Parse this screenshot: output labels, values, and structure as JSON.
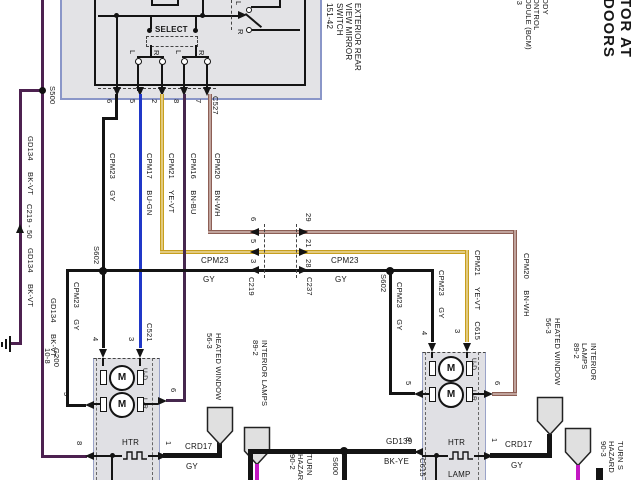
{
  "title": "TOR AT DOORS",
  "bcm": "ODY\nONTROL\nODULE (BCM)\n-3",
  "switch": {
    "name": "EXTERIOR REAR\nVIEW MIRROR\nSWITCH\n151-42",
    "select": "SELECT",
    "selector_l": "L",
    "selector_r": "R",
    "contact1": "L",
    "contact2": "R",
    "contact3": "L",
    "contact4": "R",
    "connector": "C527",
    "pin6": "6",
    "pin5": "5",
    "pin2": "2",
    "pin8": "8",
    "pin7": "7"
  },
  "wires": {
    "cpm23": "CPM23 GY",
    "cpm17": "CPM17 BU-GN",
    "cpm21": "CPM21 YE-VT",
    "cpm16": "CPM16 BN-BU",
    "cpm20": "CPM20 BN-WH",
    "cpm21_c615": "CPM21 YE-VT C615",
    "cpm23_name": "CPM23",
    "cpm23_color": "GY",
    "gd134": "GD134 BK-VT",
    "gd139_name": "GD139",
    "gd139_color": "BK-YE",
    "crd17_name": "CRD17",
    "crd17_color": "GY"
  },
  "splices": {
    "s500": "S500",
    "s602": "S602",
    "s600": "S600"
  },
  "ground": {
    "g200": "G200\n10-8"
  },
  "inline_connectors": {
    "c219": "C219",
    "c237": "C237",
    "c219_50": "C219 - 50",
    "c521": "C521",
    "c615": "C615",
    "c219_pin_a": "6",
    "c219_pin_b": "5",
    "c219_pin_c": "3",
    "c237_pin_a": "29",
    "c237_pin_b": "21",
    "c237_pin_c": "28"
  },
  "left_mirror": {
    "pin4": "4",
    "pin3": "3",
    "pin5": "5",
    "pin6": "6",
    "pin8": "8",
    "pin1": "1",
    "motor": "M",
    "ud": "U-D",
    "lr": "L-R",
    "htr": "HTR"
  },
  "right_mirror": {
    "pin4": "4",
    "pin3": "3",
    "pin5": "5",
    "pin6": "6",
    "pin8": "8",
    "pin1": "1",
    "motor": "M",
    "ud": "U-D",
    "lr": "L-R",
    "htr": "HTR",
    "lamp": "LAMP"
  },
  "offpage": {
    "heated_window": "HEATED WINDOW\n56-3",
    "interior_lamps": "INTERIOR LAMPS\n89-2",
    "turn_hazard_left": "TURN\nHAZAR\n90-2",
    "turn_hazard_right": "TURN S\nHAZARD\n90-3"
  },
  "colors": {
    "black": "#141414",
    "purple": "#4d2150",
    "blue": "#2038c8",
    "violet": "#46284e",
    "brown": "#8d5f55",
    "yellow": "#c79f1e",
    "magenta": "#c318c3",
    "box_border": "#8a96c8",
    "box_fill": "#e3e3e6"
  }
}
